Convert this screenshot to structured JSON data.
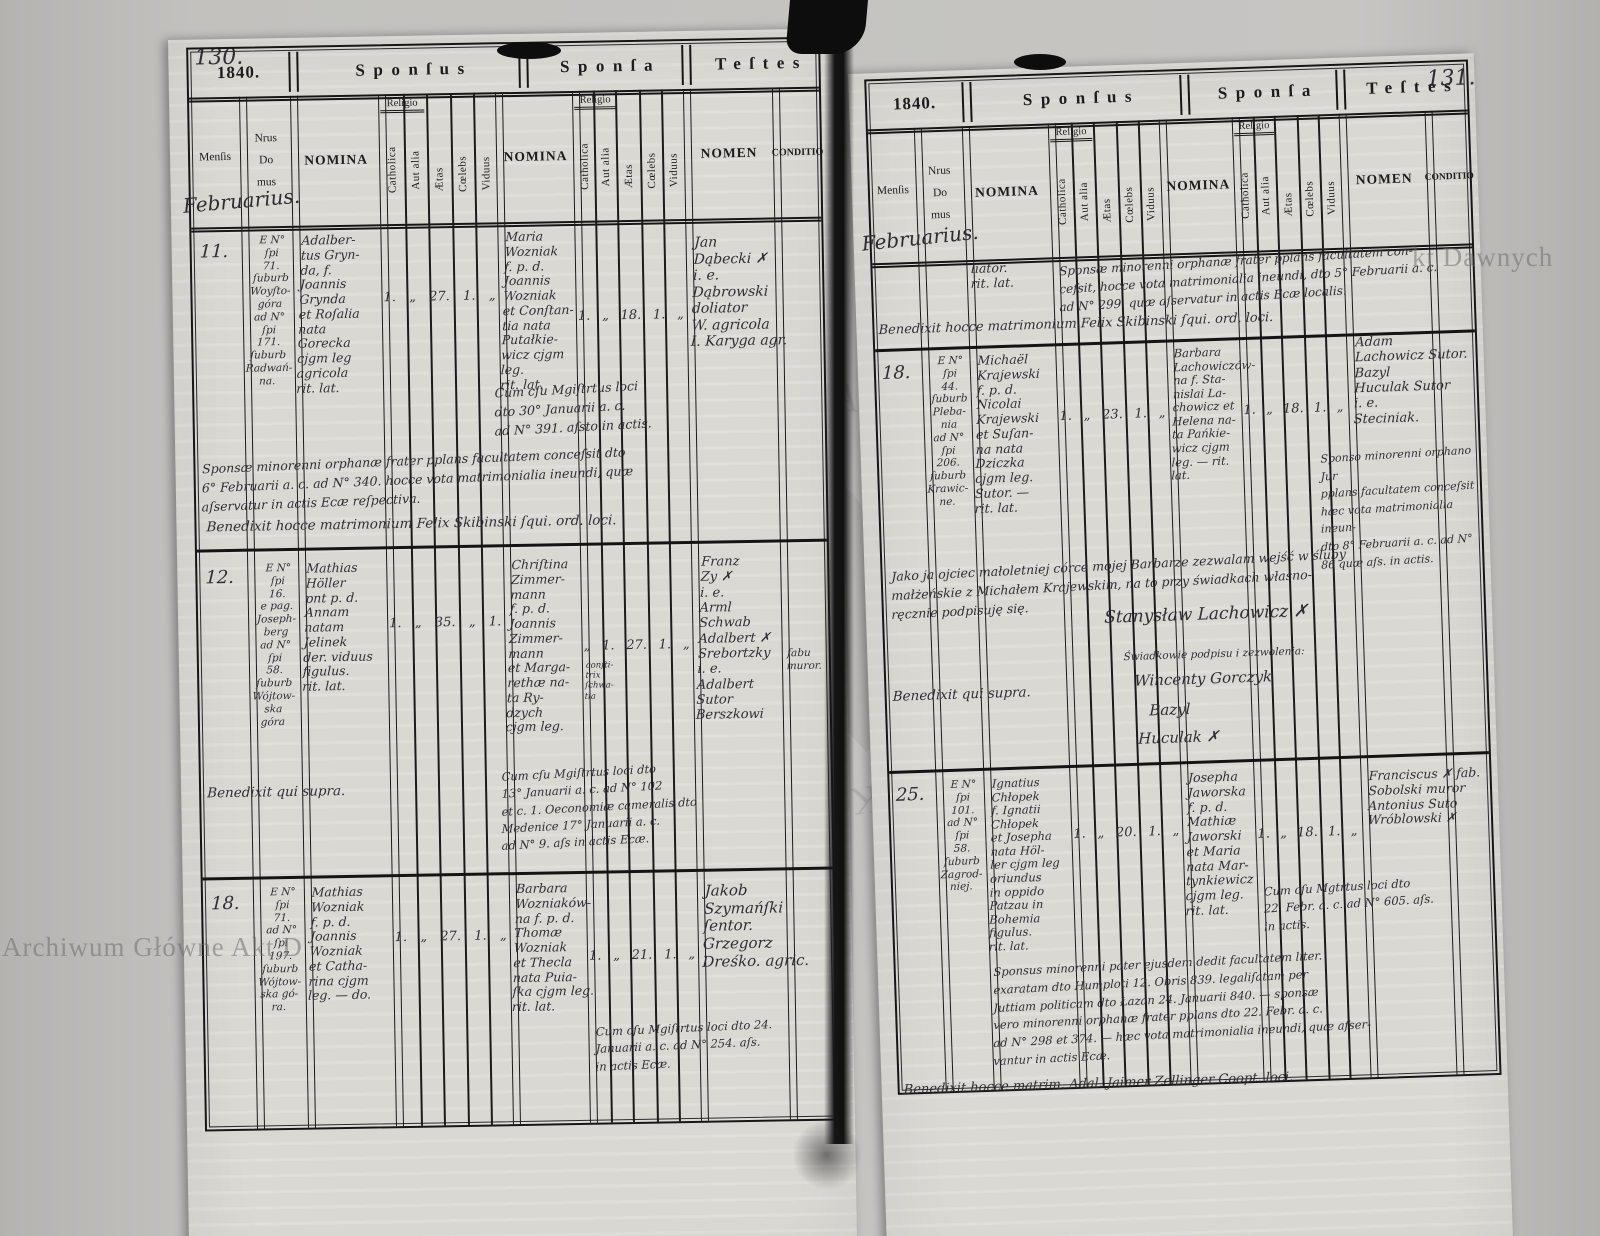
{
  "watermarks": {
    "bottom_left": "Archiwum Główne Akt D",
    "top_right": "kt Dawnych",
    "seal_text": "ARCHIWUM GŁÓWNE AKT DAWNYCH • ARCHIWUM GŁÓWNE •"
  },
  "columns": {
    "mensis": "Menſis",
    "nrus": "Nrus",
    "do": "Do",
    "mus": "mus",
    "nomina": "NOMINA",
    "religio": "Religio",
    "catholica": "Catholica",
    "aut_alia": "Aut alia",
    "aetas": "Ætas",
    "coelebs": "Cœlebs",
    "viduus": "Viduus",
    "nomen": "NOMEN",
    "conditio": "CONDITIO"
  },
  "pages": {
    "left": {
      "page_number": "130.",
      "year": "1840.",
      "sections": [
        "Sponſus",
        "Sponſa",
        "Teſtes"
      ],
      "month_hand": "Februarius.",
      "entries": [
        {
          "num": "11.",
          "house": "E N°\nſpi\n71.\nſuburb\nWoyſto-\ngóra\nad N°\nſpi\n171.\nſuburb\nRadwań-\nna.",
          "sponsus": "Adalber-\ntus Gryn-\nda, f.\nJoannis\nGrynda\net Roſalia\nnata\nGorecka\ncjgm leg\nagricola\nrit. lat.",
          "sponsus_stats": [
            "1.",
            "„",
            "27.",
            "1.",
            "„"
          ],
          "sponsa": "Maria\nWozniak\nf. p. d.\nJoannis\nWozniak\net Conſtan-\ntia nata\nPutałkie-\nwicz cjgm\nleg.\nrit. lat.",
          "sponsa_stats": [
            "1.",
            "„",
            "18.",
            "1.",
            "„"
          ],
          "testes": "Jan\nDąbecki ✗\ni. e.\nDąbrowski doliator\nW. agricola\nI. Karyga agr.",
          "note_cum": "Cum cſu Mgiſtrtus loci\ndto 30° Januarii a. c.\nad N° 391. aſsto in actis.",
          "note_span": "Sponsæ minorenni orphanæ frater pplans facultatem conceſsit dto\n6° Februarii a. c. ad N° 340. hocce vota matrimonialia ineundi, quæ\naſservatur in actis Ecæ reſpectiva.",
          "note_bene": "Benedixit hocce matrimonium Felix Skibinski ſqui. ord. loci."
        },
        {
          "num": "12.",
          "house": "E N°\nſpi\n16.\ne pag.\nJoseph-\nberg\nad N°\nſpi\n58.\nſuburb\nWójtow-\nska\ngóra",
          "sponsus": "Mathias\nHöller\npnt p. d.\nAnnam\nnatam\nJelinek\nder. viduus\nfigulus.\nrit. lat.",
          "sponsus_stats": [
            "1.",
            "„",
            "35.",
            "„",
            "1."
          ],
          "sponsa": "Chriſtina\nZimmer-\nmann\nf. p. d.\nJoannis\nZimmer-\nmann\net Marga-\nrethæ na-\nta Ry-\ndzych\ncjgm leg.",
          "sponsa_side": "conſti-\ntrix\nſchwa-\ntia",
          "sponsa_stats": [
            "„",
            "1.",
            "27.",
            "1.",
            "„"
          ],
          "testes": "Franz\nZy ✗\ni. e.\nArml\nSchwab\nAdalbert ✗\nSrebortzky\ni. e.\nAdalbert Sutor\nBerszkowi",
          "conditio": "fabu\nmuror.",
          "note_cum": "Cum cſu Mgiſtrtus loci dto\n13° Januarii a. c. ad N° 102\net c. 1. Oeconomiæ cameralis dto\nMedenice 17° Januarii a. c.\nad N° 9. aſs in actis Ecæ.",
          "note_bene": "Benedixit qui supra."
        },
        {
          "num": "18.",
          "house": "E N°\nſpi\n71.\nad N°\nſpi\n197.\nſuburb\nWójtow-\nska gó-\nra.",
          "sponsus": "Mathias\nWozniak\nf. p. d.\nJoannis\nWozniak\net Catha-\nrina cjgm\nleg. — do.",
          "sponsus_stats": [
            "1.",
            "„",
            "27.",
            "1.",
            "„"
          ],
          "sponsa": "Barbara\nWozniaków-\nna f. p. d.\nThomæ\nWozniak\net Thecla\nnata Puia-\nſka cjgm leg.\nrit. lat.",
          "sponsa_stats": [
            "1.",
            "„",
            "21.",
            "1.",
            "„"
          ],
          "testes": "Jakob\nSzymańſki\nſentor.\nGrzegorz\nDreśko. agric.",
          "note_cum": "Cum cſu Mgiſtrtus loci dto 24.\nJanuarii a. c. ad N° 254. aſs.\nin actis Ecæ."
        }
      ]
    },
    "right": {
      "page_number": "131.",
      "year": "1840.",
      "sections": [
        "Sponſus",
        "Sponſa",
        "Teſtes"
      ],
      "month_hand": "Februarius.",
      "continuation": {
        "sponsus_tail": "liator.\nrit. lat.",
        "note": "Sponsæ minorenni orphanæ frater pplans facultatem con-\nceſsit, hocce vota matrimonialia ineundi, dto 5° Februarii a. c.\nad N° 299. quæ aſservatur in actis Ecæ localis.",
        "bene": "Benedixit hocce matrimonium Felix Skibinski ſqui. ord. loci."
      },
      "entries": [
        {
          "num": "18.",
          "house": "E N°\nſpi\n44.\nſuburb\nPleba-\nnia\nad N°\nſpi\n206.\nſuburb\nKrawic-\nne.",
          "sponsus": "Michaël\nKrajewski\nf. p. d.\nNicolai\nKrajewski\net Suſan-\nna nata\nDziczka\ncjgm leg.\nSutor. —\nrit. lat.",
          "sponsus_stats": [
            "1.",
            "„",
            "23.",
            "1.",
            "„"
          ],
          "sponsa": "Barbara\nLachowiczów-\nna f. Sta-\nnislai La-\nchowicz et\nHelena na-\nta Pańkie-\nwicz cjgm\nleg. — rit.\nlat.",
          "sponsa_stats": [
            "1.",
            "„",
            "18.",
            "1.",
            "„"
          ],
          "testes": "Adam\nLachowicz  Sutor.\nBazyl\nHuculak  Sutor\ni. e.\nSteciniak.",
          "note_cum": "Sponso minorenni orphano Jur\npplans facultatem conceſsit\nhæc vota matrimonialia ineun-\ndto 8° Februarii a. c. ad N°\n86 quæ aſs. in actis.",
          "polish_note": "Jako ja ojciec małoletniej córce mojej Barbarze zezwalam wejść w śluby\nmałżeńskie z Michałem Krajewskim, na to przy świadkach własno-\nręcznie podpisuję się.",
          "signature": "Stanysław Lachowicz ✗",
          "witness_label": "Świadkowie podpisu i zezwolenia:",
          "witness_1": "Wincenty Gorczyk",
          "witness_2": "Bazyl",
          "witness_3": "Huculak ✗",
          "note_bene": "Benedixit qui supra."
        },
        {
          "num": "25.",
          "house": "E N°\nſpi\n101.\nad N°\nſpi\n58.\nſuburb\nZagrod-\nniej.",
          "sponsus": "Ignatius\nChłopek\nf. Ignatii\nChłopek\net Josepha\nnata Höl-\nler cjgm leg\noriundus\nin oppido\nPatzau in\nBohemia\nfigulus.\nrit. lat.",
          "sponsus_stats": [
            "1.",
            "„",
            "20.",
            "1.",
            "„"
          ],
          "sponsa": "Josepha\nJaworska\nf. p. d.\nMathiæ\nJaworski\net Maria\nnata Mar-\ntynkiewicz\ncjgm leg.\nrit. lat.",
          "sponsa_stats": [
            "1.",
            "„",
            "18.",
            "1.",
            "„"
          ],
          "testes": "Franciscus ✗  fab.\nSobolski  muror\nAntonius  Suto\nWróblowski ✗",
          "note_cum": "Cum cſu Mgtrtus loci dto\n22. Febr. a. c. ad N° 605. aſs.\nin actis.",
          "bottom_note": "Sponsus minorenni pater ejusdem dedit facultatem liter.\nexaratam dto Humploti 12. Obris 839. legaliſatam per\nJuttiam politicam dto Łazan 24. Januarii 840. — sponsæ\nvero minorenni orphanæ frater pplans dto 22. Febr. a. c.\nad N° 298 et 374. — hæc vota matrimonialia ineundi, quæ aſser-\nvantur in actis Ecæ.",
          "note_bene": "Benedixit hocce matrim. Adal. Jaimer Zellinger Coopt. loci."
        }
      ]
    }
  }
}
